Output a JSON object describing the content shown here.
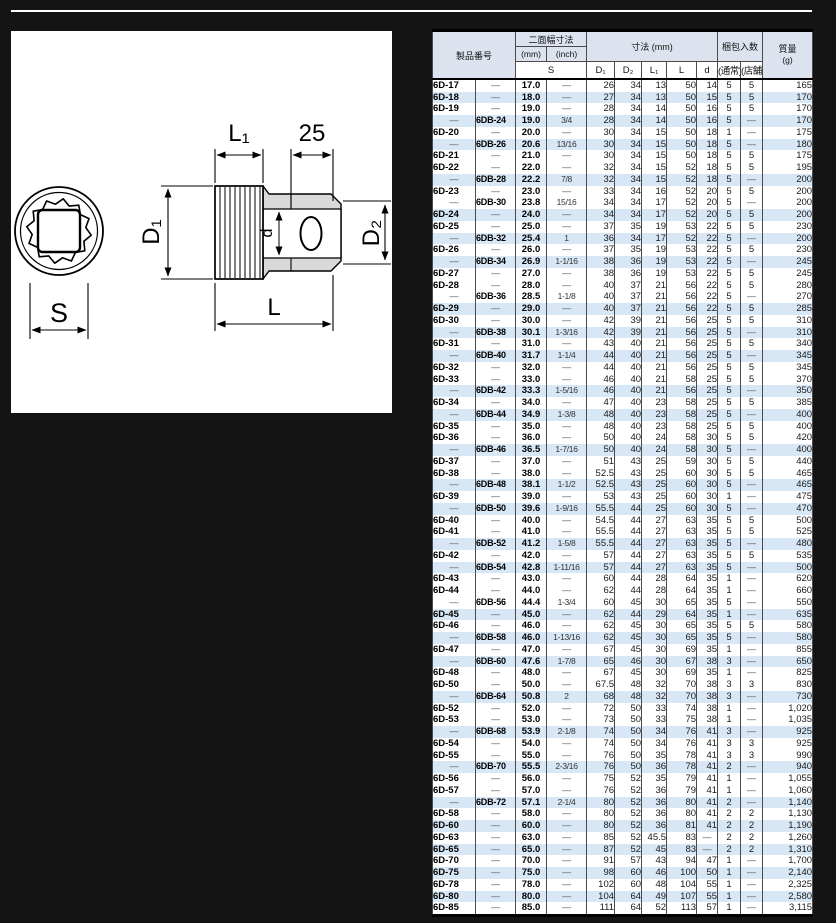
{
  "page": {
    "background_color": "#141414",
    "panel_color": "#ffffff",
    "header_bg": "#dde3ee",
    "stripe_bg": "#d8e7f5"
  },
  "diagram": {
    "labels": {
      "l1": "L₁",
      "drive_len": "25",
      "d1": "D₁",
      "d2": "D₂",
      "d_small": "d",
      "length": "L",
      "width_across_flats": "S"
    }
  },
  "table": {
    "header": {
      "product_no": "製品番号",
      "width_across_flats": "二面幅寸法",
      "mm": "(mm)",
      "inch": "(inch)",
      "s": "S",
      "dimensions": "寸法 (mm)",
      "dim_cols": [
        "D₁",
        "D₂",
        "L₁",
        "L",
        "d"
      ],
      "packing": "梱包入数",
      "packing_normal": "(通常)",
      "packing_store": "(店舗)",
      "mass_line1": "質量",
      "mass_line2": "(g)"
    },
    "striped_row_indices": [
      1,
      3,
      5,
      8,
      11,
      13,
      15,
      19,
      21,
      23,
      26,
      28,
      31,
      34,
      36,
      39,
      41,
      45,
      47,
      49,
      52,
      55,
      58,
      61,
      63,
      65,
      67,
      69
    ],
    "rows": [
      [
        "6D-17",
        "—",
        "17.0",
        "—",
        "26",
        "34",
        "13",
        "50",
        "14",
        "5",
        "5",
        "165"
      ],
      [
        "6D-18",
        "—",
        "18.0",
        "—",
        "27",
        "34",
        "13",
        "50",
        "15",
        "5",
        "5",
        "170"
      ],
      [
        "6D-19",
        "—",
        "19.0",
        "—",
        "28",
        "34",
        "14",
        "50",
        "16",
        "5",
        "5",
        "170"
      ],
      [
        "—",
        "6DB-24",
        "19.0",
        "3/4",
        "28",
        "34",
        "14",
        "50",
        "16",
        "5",
        "—",
        "170"
      ],
      [
        "6D-20",
        "—",
        "20.0",
        "—",
        "30",
        "34",
        "15",
        "50",
        "18",
        "1",
        "—",
        "175"
      ],
      [
        "—",
        "6DB-26",
        "20.6",
        "13/16",
        "30",
        "34",
        "15",
        "50",
        "18",
        "5",
        "—",
        "180"
      ],
      [
        "6D-21",
        "—",
        "21.0",
        "—",
        "30",
        "34",
        "15",
        "50",
        "18",
        "5",
        "5",
        "175"
      ],
      [
        "6D-22",
        "—",
        "22.0",
        "—",
        "32",
        "34",
        "15",
        "52",
        "18",
        "5",
        "5",
        "195"
      ],
      [
        "—",
        "6DB-28",
        "22.2",
        "7/8",
        "32",
        "34",
        "15",
        "52",
        "18",
        "5",
        "—",
        "200"
      ],
      [
        "6D-23",
        "—",
        "23.0",
        "—",
        "33",
        "34",
        "16",
        "52",
        "20",
        "5",
        "5",
        "200"
      ],
      [
        "—",
        "6DB-30",
        "23.8",
        "15/16",
        "34",
        "34",
        "17",
        "52",
        "20",
        "5",
        "—",
        "200"
      ],
      [
        "6D-24",
        "—",
        "24.0",
        "—",
        "34",
        "34",
        "17",
        "52",
        "20",
        "5",
        "5",
        "200"
      ],
      [
        "6D-25",
        "—",
        "25.0",
        "—",
        "37",
        "35",
        "19",
        "53",
        "22",
        "5",
        "5",
        "230"
      ],
      [
        "—",
        "6DB-32",
        "25.4",
        "1",
        "36",
        "34",
        "17",
        "52",
        "22",
        "5",
        "—",
        "200"
      ],
      [
        "6D-26",
        "—",
        "26.0",
        "—",
        "37",
        "35",
        "19",
        "53",
        "22",
        "5",
        "5",
        "230"
      ],
      [
        "—",
        "6DB-34",
        "26.9",
        "1-1/16",
        "38",
        "36",
        "19",
        "53",
        "22",
        "5",
        "—",
        "245"
      ],
      [
        "6D-27",
        "—",
        "27.0",
        "—",
        "38",
        "36",
        "19",
        "53",
        "22",
        "5",
        "5",
        "245"
      ],
      [
        "6D-28",
        "—",
        "28.0",
        "—",
        "40",
        "37",
        "21",
        "56",
        "22",
        "5",
        "5",
        "280"
      ],
      [
        "—",
        "6DB-36",
        "28.5",
        "1-1/8",
        "40",
        "37",
        "21",
        "56",
        "22",
        "5",
        "—",
        "270"
      ],
      [
        "6D-29",
        "—",
        "29.0",
        "—",
        "40",
        "37",
        "21",
        "56",
        "22",
        "5",
        "5",
        "285"
      ],
      [
        "6D-30",
        "—",
        "30.0",
        "—",
        "42",
        "39",
        "21",
        "56",
        "25",
        "5",
        "5",
        "310"
      ],
      [
        "—",
        "6DB-38",
        "30.1",
        "1-3/16",
        "42",
        "39",
        "21",
        "56",
        "25",
        "5",
        "—",
        "310"
      ],
      [
        "6D-31",
        "—",
        "31.0",
        "—",
        "43",
        "40",
        "21",
        "56",
        "25",
        "5",
        "5",
        "340"
      ],
      [
        "—",
        "6DB-40",
        "31.7",
        "1-1/4",
        "44",
        "40",
        "21",
        "56",
        "25",
        "5",
        "—",
        "345"
      ],
      [
        "6D-32",
        "—",
        "32.0",
        "—",
        "44",
        "40",
        "21",
        "56",
        "25",
        "5",
        "5",
        "345"
      ],
      [
        "6D-33",
        "—",
        "33.0",
        "—",
        "46",
        "40",
        "21",
        "58",
        "25",
        "5",
        "5",
        "370"
      ],
      [
        "—",
        "6DB-42",
        "33.3",
        "1-5/16",
        "46",
        "40",
        "21",
        "56",
        "25",
        "5",
        "—",
        "350"
      ],
      [
        "6D-34",
        "—",
        "34.0",
        "—",
        "47",
        "40",
        "23",
        "58",
        "25",
        "5",
        "5",
        "385"
      ],
      [
        "—",
        "6DB-44",
        "34.9",
        "1-3/8",
        "48",
        "40",
        "23",
        "58",
        "25",
        "5",
        "—",
        "400"
      ],
      [
        "6D-35",
        "—",
        "35.0",
        "—",
        "48",
        "40",
        "23",
        "58",
        "25",
        "5",
        "5",
        "400"
      ],
      [
        "6D-36",
        "—",
        "36.0",
        "—",
        "50",
        "40",
        "24",
        "58",
        "30",
        "5",
        "5",
        "420"
      ],
      [
        "—",
        "6DB-46",
        "36.5",
        "1-7/16",
        "50",
        "40",
        "24",
        "58",
        "30",
        "5",
        "—",
        "400"
      ],
      [
        "6D-37",
        "—",
        "37.0",
        "—",
        "51",
        "43",
        "25",
        "59",
        "30",
        "5",
        "5",
        "440"
      ],
      [
        "6D-38",
        "—",
        "38.0",
        "—",
        "52.5",
        "43",
        "25",
        "60",
        "30",
        "5",
        "5",
        "465"
      ],
      [
        "—",
        "6DB-48",
        "38.1",
        "1-1/2",
        "52.5",
        "43",
        "25",
        "60",
        "30",
        "5",
        "—",
        "465"
      ],
      [
        "6D-39",
        "—",
        "39.0",
        "—",
        "53",
        "43",
        "25",
        "60",
        "30",
        "1",
        "—",
        "475"
      ],
      [
        "—",
        "6DB-50",
        "39.6",
        "1-9/16",
        "55.5",
        "44",
        "25",
        "60",
        "30",
        "5",
        "—",
        "470"
      ],
      [
        "6D-40",
        "—",
        "40.0",
        "—",
        "54.5",
        "44",
        "27",
        "63",
        "35",
        "5",
        "5",
        "500"
      ],
      [
        "6D-41",
        "—",
        "41.0",
        "—",
        "55.5",
        "44",
        "27",
        "63",
        "35",
        "5",
        "5",
        "525"
      ],
      [
        "—",
        "6DB-52",
        "41.2",
        "1-5/8",
        "55.5",
        "44",
        "27",
        "63",
        "35",
        "5",
        "—",
        "480"
      ],
      [
        "6D-42",
        "—",
        "42.0",
        "—",
        "57",
        "44",
        "27",
        "63",
        "35",
        "5",
        "5",
        "535"
      ],
      [
        "—",
        "6DB-54",
        "42.8",
        "1-11/16",
        "57",
        "44",
        "27",
        "63",
        "35",
        "5",
        "—",
        "500"
      ],
      [
        "6D-43",
        "—",
        "43.0",
        "—",
        "60",
        "44",
        "28",
        "64",
        "35",
        "1",
        "—",
        "620"
      ],
      [
        "6D-44",
        "—",
        "44.0",
        "—",
        "62",
        "44",
        "28",
        "64",
        "35",
        "1",
        "—",
        "660"
      ],
      [
        "—",
        "6DB-56",
        "44.4",
        "1-3/4",
        "60",
        "45",
        "30",
        "65",
        "35",
        "5",
        "—",
        "550"
      ],
      [
        "6D-45",
        "—",
        "45.0",
        "—",
        "62",
        "44",
        "29",
        "64",
        "35",
        "1",
        "—",
        "635"
      ],
      [
        "6D-46",
        "—",
        "46.0",
        "—",
        "62",
        "45",
        "30",
        "65",
        "35",
        "5",
        "5",
        "580"
      ],
      [
        "—",
        "6DB-58",
        "46.0",
        "1-13/16",
        "62",
        "45",
        "30",
        "65",
        "35",
        "5",
        "—",
        "580"
      ],
      [
        "6D-47",
        "—",
        "47.0",
        "—",
        "67",
        "45",
        "30",
        "69",
        "35",
        "1",
        "—",
        "855"
      ],
      [
        "—",
        "6DB-60",
        "47.6",
        "1-7/8",
        "65",
        "46",
        "30",
        "67",
        "38",
        "3",
        "—",
        "650"
      ],
      [
        "6D-48",
        "—",
        "48.0",
        "—",
        "67",
        "45",
        "30",
        "69",
        "35",
        "1",
        "—",
        "825"
      ],
      [
        "6D-50",
        "—",
        "50.0",
        "—",
        "67.5",
        "48",
        "32",
        "70",
        "38",
        "3",
        "3",
        "830"
      ],
      [
        "—",
        "6DB-64",
        "50.8",
        "2",
        "68",
        "48",
        "32",
        "70",
        "38",
        "3",
        "—",
        "730"
      ],
      [
        "6D-52",
        "—",
        "52.0",
        "—",
        "72",
        "50",
        "33",
        "74",
        "38",
        "1",
        "—",
        "1,020"
      ],
      [
        "6D-53",
        "—",
        "53.0",
        "—",
        "73",
        "50",
        "33",
        "75",
        "38",
        "1",
        "—",
        "1,035"
      ],
      [
        "—",
        "6DB-68",
        "53.9",
        "2-1/8",
        "74",
        "50",
        "34",
        "76",
        "41",
        "3",
        "—",
        "925"
      ],
      [
        "6D-54",
        "—",
        "54.0",
        "—",
        "74",
        "50",
        "34",
        "76",
        "41",
        "3",
        "3",
        "925"
      ],
      [
        "6D-55",
        "—",
        "55.0",
        "—",
        "76",
        "50",
        "35",
        "78",
        "41",
        "3",
        "3",
        "990"
      ],
      [
        "—",
        "6DB-70",
        "55.5",
        "2-3/16",
        "76",
        "50",
        "36",
        "78",
        "41",
        "2",
        "—",
        "940"
      ],
      [
        "6D-56",
        "—",
        "56.0",
        "—",
        "75",
        "52",
        "35",
        "79",
        "41",
        "1",
        "—",
        "1,055"
      ],
      [
        "6D-57",
        "—",
        "57.0",
        "—",
        "76",
        "52",
        "36",
        "79",
        "41",
        "1",
        "—",
        "1,060"
      ],
      [
        "—",
        "6DB-72",
        "57.1",
        "2-1/4",
        "80",
        "52",
        "36",
        "80",
        "41",
        "2",
        "—",
        "1,140"
      ],
      [
        "6D-58",
        "—",
        "58.0",
        "—",
        "80",
        "52",
        "36",
        "80",
        "41",
        "2",
        "2",
        "1,130"
      ],
      [
        "6D-60",
        "—",
        "60.0",
        "—",
        "80",
        "52",
        "36",
        "81",
        "41",
        "2",
        "2",
        "1,190"
      ],
      [
        "6D-63",
        "—",
        "63.0",
        "—",
        "85",
        "52",
        "45.5",
        "83",
        "—",
        "2",
        "2",
        "1,260"
      ],
      [
        "6D-65",
        "—",
        "65.0",
        "—",
        "87",
        "52",
        "45",
        "83",
        "—",
        "2",
        "2",
        "1,310"
      ],
      [
        "6D-70",
        "—",
        "70.0",
        "—",
        "91",
        "57",
        "43",
        "94",
        "47",
        "1",
        "—",
        "1,700"
      ],
      [
        "6D-75",
        "—",
        "75.0",
        "—",
        "98",
        "60",
        "46",
        "100",
        "50",
        "1",
        "—",
        "2,140"
      ],
      [
        "6D-78",
        "—",
        "78.0",
        "—",
        "102",
        "60",
        "48",
        "104",
        "55",
        "1",
        "—",
        "2,325"
      ],
      [
        "6D-80",
        "—",
        "80.0",
        "—",
        "104",
        "64",
        "49",
        "107",
        "55",
        "1",
        "—",
        "2,580"
      ],
      [
        "6D-85",
        "—",
        "85.0",
        "—",
        "111",
        "64",
        "52",
        "113",
        "57",
        "1",
        "—",
        "3,115"
      ]
    ]
  }
}
